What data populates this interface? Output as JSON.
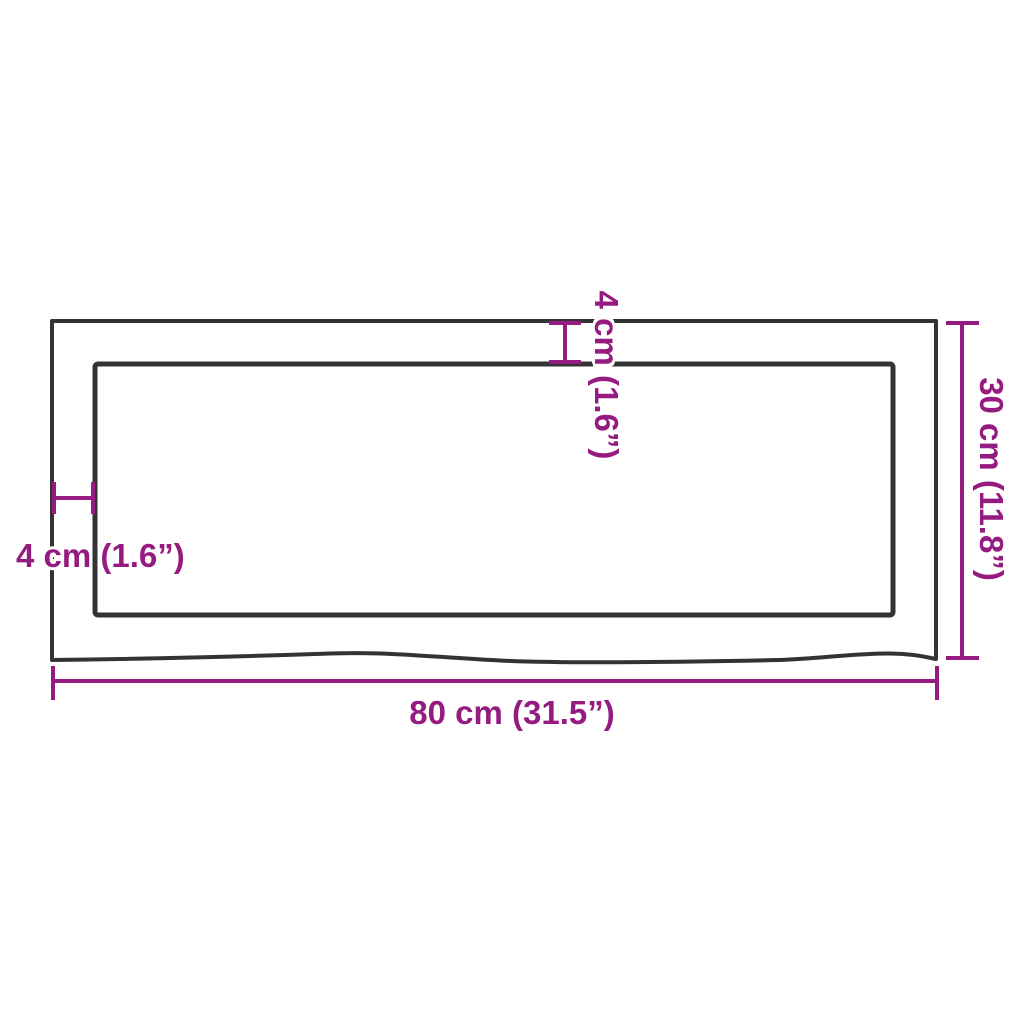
{
  "dimensions": {
    "width_label": "80 cm (31.5”)",
    "height_label": "30 cm (11.8”)",
    "top_thickness_label": "4 cm (1.6”)",
    "left_thickness_label": "4 cm (1.6”)"
  },
  "colors": {
    "dimension_accent": "#951b81",
    "outline_dark": "#333333",
    "background": "#ffffff"
  }
}
